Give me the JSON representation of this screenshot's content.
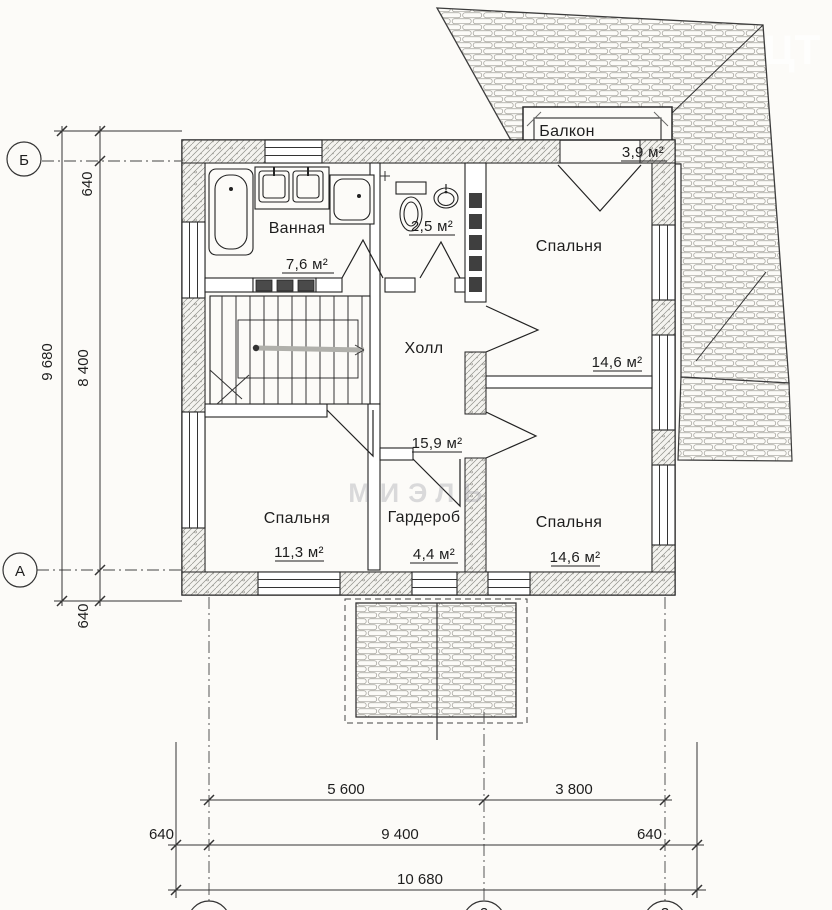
{
  "rooms": {
    "bathroom": {
      "label": "Ванная",
      "area": "7,6 м²"
    },
    "wc": {
      "area": "2,5 м²"
    },
    "hall": {
      "label": "Холл",
      "area": "15,9 м²"
    },
    "bedroom_top": {
      "label": "Спальня",
      "area": "14,6 м²"
    },
    "balcony": {
      "label": "Балкон",
      "area": "3,9 м²"
    },
    "bedroom_left": {
      "label": "Спальня",
      "area": "11,3 м²"
    },
    "wardrobe": {
      "label": "Гардероб",
      "area": "4,4 м²"
    },
    "bedroom_right": {
      "label": "Спальня",
      "area": "14,6 м²"
    }
  },
  "axes": {
    "left_top": "Б",
    "left_bottom": "А",
    "bottom_mid": "2",
    "bottom_right": "3"
  },
  "dims": {
    "left": [
      "640",
      "9 680",
      "8 400",
      "640"
    ],
    "bottom": [
      "5 600",
      "3 800",
      "640",
      "9 400",
      "640",
      "10 680"
    ]
  },
  "watermarks": {
    "center": "МИЭЛЬ",
    "top_right": "ЦТ"
  }
}
